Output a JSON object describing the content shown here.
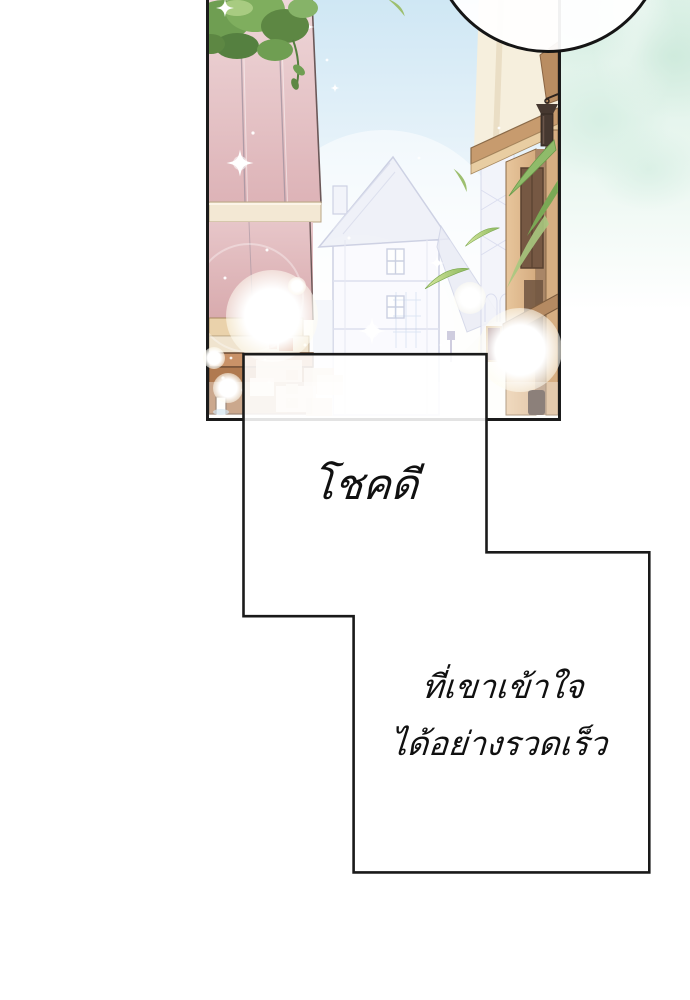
{
  "captions": {
    "top": "โชคดี",
    "bottom_line1": "ที่เขาเข้าใจ",
    "bottom_line2": "ได้อย่างรวดเร็ว"
  },
  "colors": {
    "panel_border": "#1b1b1b",
    "caption_border": "#1a1a1a",
    "caption_text": "#101010",
    "mint_background": "#d7efe3",
    "sky_blue": "#cfe7f4",
    "wall_pink": "#e2bcc0",
    "building_tan": "#dcb68c",
    "stall_brown": "#b07a50",
    "foliage_green": "#6f9e52",
    "leaf_green": "#8cb85e",
    "lantern_brown": "#463830",
    "distant_house_line": "#c6cadf"
  },
  "scene_elements": [
    "speech-bubble-circle",
    "street-scene-panel",
    "pink-paneled-wall",
    "tree-foliage",
    "distant-half-timbered-house",
    "right-tan-building",
    "hanging-lantern",
    "market-stall",
    "floating-leaves",
    "grass-blades",
    "bokeh-lights",
    "sparkle-stars",
    "mint-texture-background",
    "caption-box"
  ]
}
